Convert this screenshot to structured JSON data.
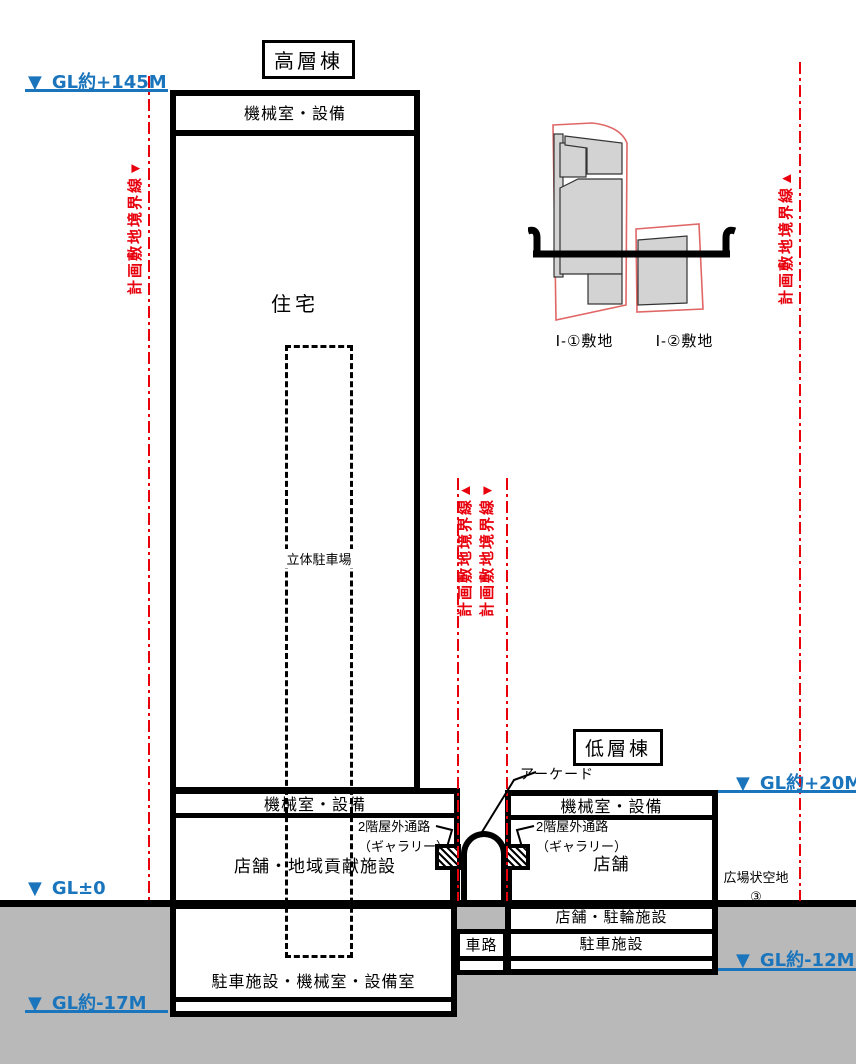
{
  "titles": {
    "high_rise": "高層棟",
    "low_rise": "低層棟"
  },
  "levels": {
    "gl_plus145": "GL約+145M",
    "gl_zero": "GL±0",
    "gl_plus20": "GL約+20M",
    "gl_minus12": "GL約-12M",
    "gl_minus17": "GL約-17M"
  },
  "glyphs": {
    "down_triangle": "▼"
  },
  "boundary": {
    "label": "計画敷地境界線",
    "left_triangle": "▼",
    "center_left_triangle": "▲",
    "center_right_triangle": "▼",
    "right_triangle": "▲"
  },
  "high_rise": {
    "machine_room_top": "機械室・設備",
    "residence": "住宅",
    "parking_tower": "立体駐車場",
    "machine_room_low": "機械室・設備",
    "shop_community": "店舗・地域貢献施設",
    "basement": "駐車施設・機械室・設備室"
  },
  "low_rise": {
    "machine_room": "機械室・設備",
    "shop": "店舗",
    "shop_bicycle": "店舗・駐輪施設",
    "parking": "駐車施設"
  },
  "center": {
    "arcade": "アーケード",
    "gallery_line1": "2階屋外通路",
    "gallery_line2": "（ギャラリー）",
    "driveway": "車路"
  },
  "site": {
    "plaza_line1": "広場状空地",
    "plaza_line2": "③",
    "parcel1": "Ⅰ-①敷地",
    "parcel2": "Ⅰ-②敷地"
  },
  "colors": {
    "boundary_red": "#e8000d",
    "level_blue": "#1b75bc",
    "ground_gray": "#b9b9b9"
  }
}
